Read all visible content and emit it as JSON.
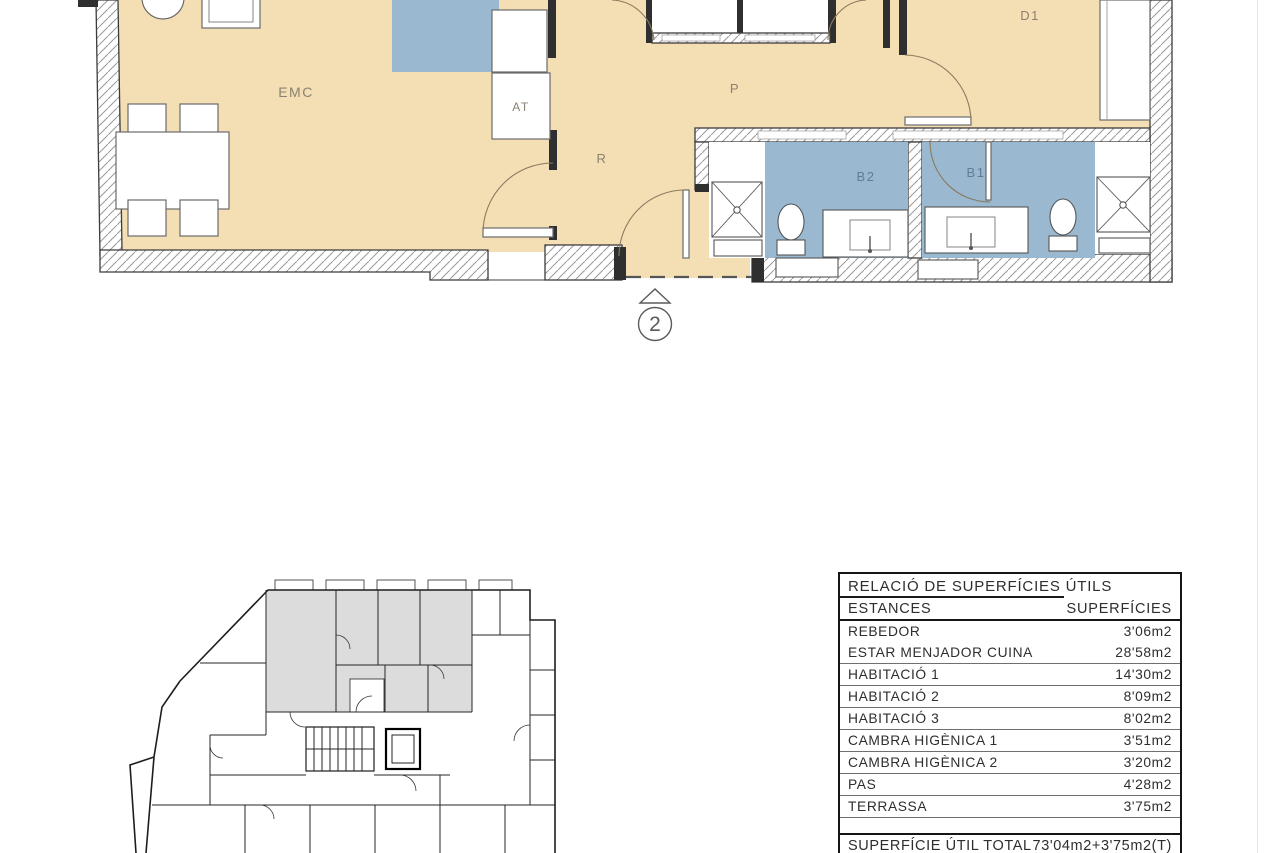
{
  "plan": {
    "rooms": {
      "emc": "EMC",
      "at": "AT",
      "r": "R",
      "p": "P",
      "d1": "D1",
      "b1": "B1",
      "b2": "B2"
    },
    "entrance_marker": "2",
    "colors": {
      "floor_beige": "#f4dfb5",
      "wet_blue": "#9ab9d1",
      "keyplan_gray": "#dcdcdc"
    }
  },
  "table": {
    "title": "RELACIÓ DE SUPERFÍCIES ÚTILS",
    "col_room": "ESTANCES",
    "col_area": "SUPERFÍCIES",
    "rows": [
      {
        "name": "REBEDOR",
        "area": "3'06m2"
      },
      {
        "name": "ESTAR MENJADOR CUINA",
        "area": "28'58m2"
      },
      {
        "name": "HABITACIÓ 1",
        "area": "14'30m2"
      },
      {
        "name": "HABITACIÓ 2",
        "area": "8'09m2"
      },
      {
        "name": "HABITACIÓ 3",
        "area": "8'02m2"
      },
      {
        "name": "CAMBRA HIGÈNICA 1",
        "area": "3'51m2"
      },
      {
        "name": "CAMBRA HIGÈNICA 2",
        "area": "3'20m2"
      },
      {
        "name": "PAS",
        "area": "4'28m2"
      },
      {
        "name": "TERRASSA",
        "area": "3'75m2"
      }
    ],
    "total_label": "SUPERFÍCIE ÚTIL TOTAL",
    "total_value": "73'04m2+3'75m2(T)"
  }
}
